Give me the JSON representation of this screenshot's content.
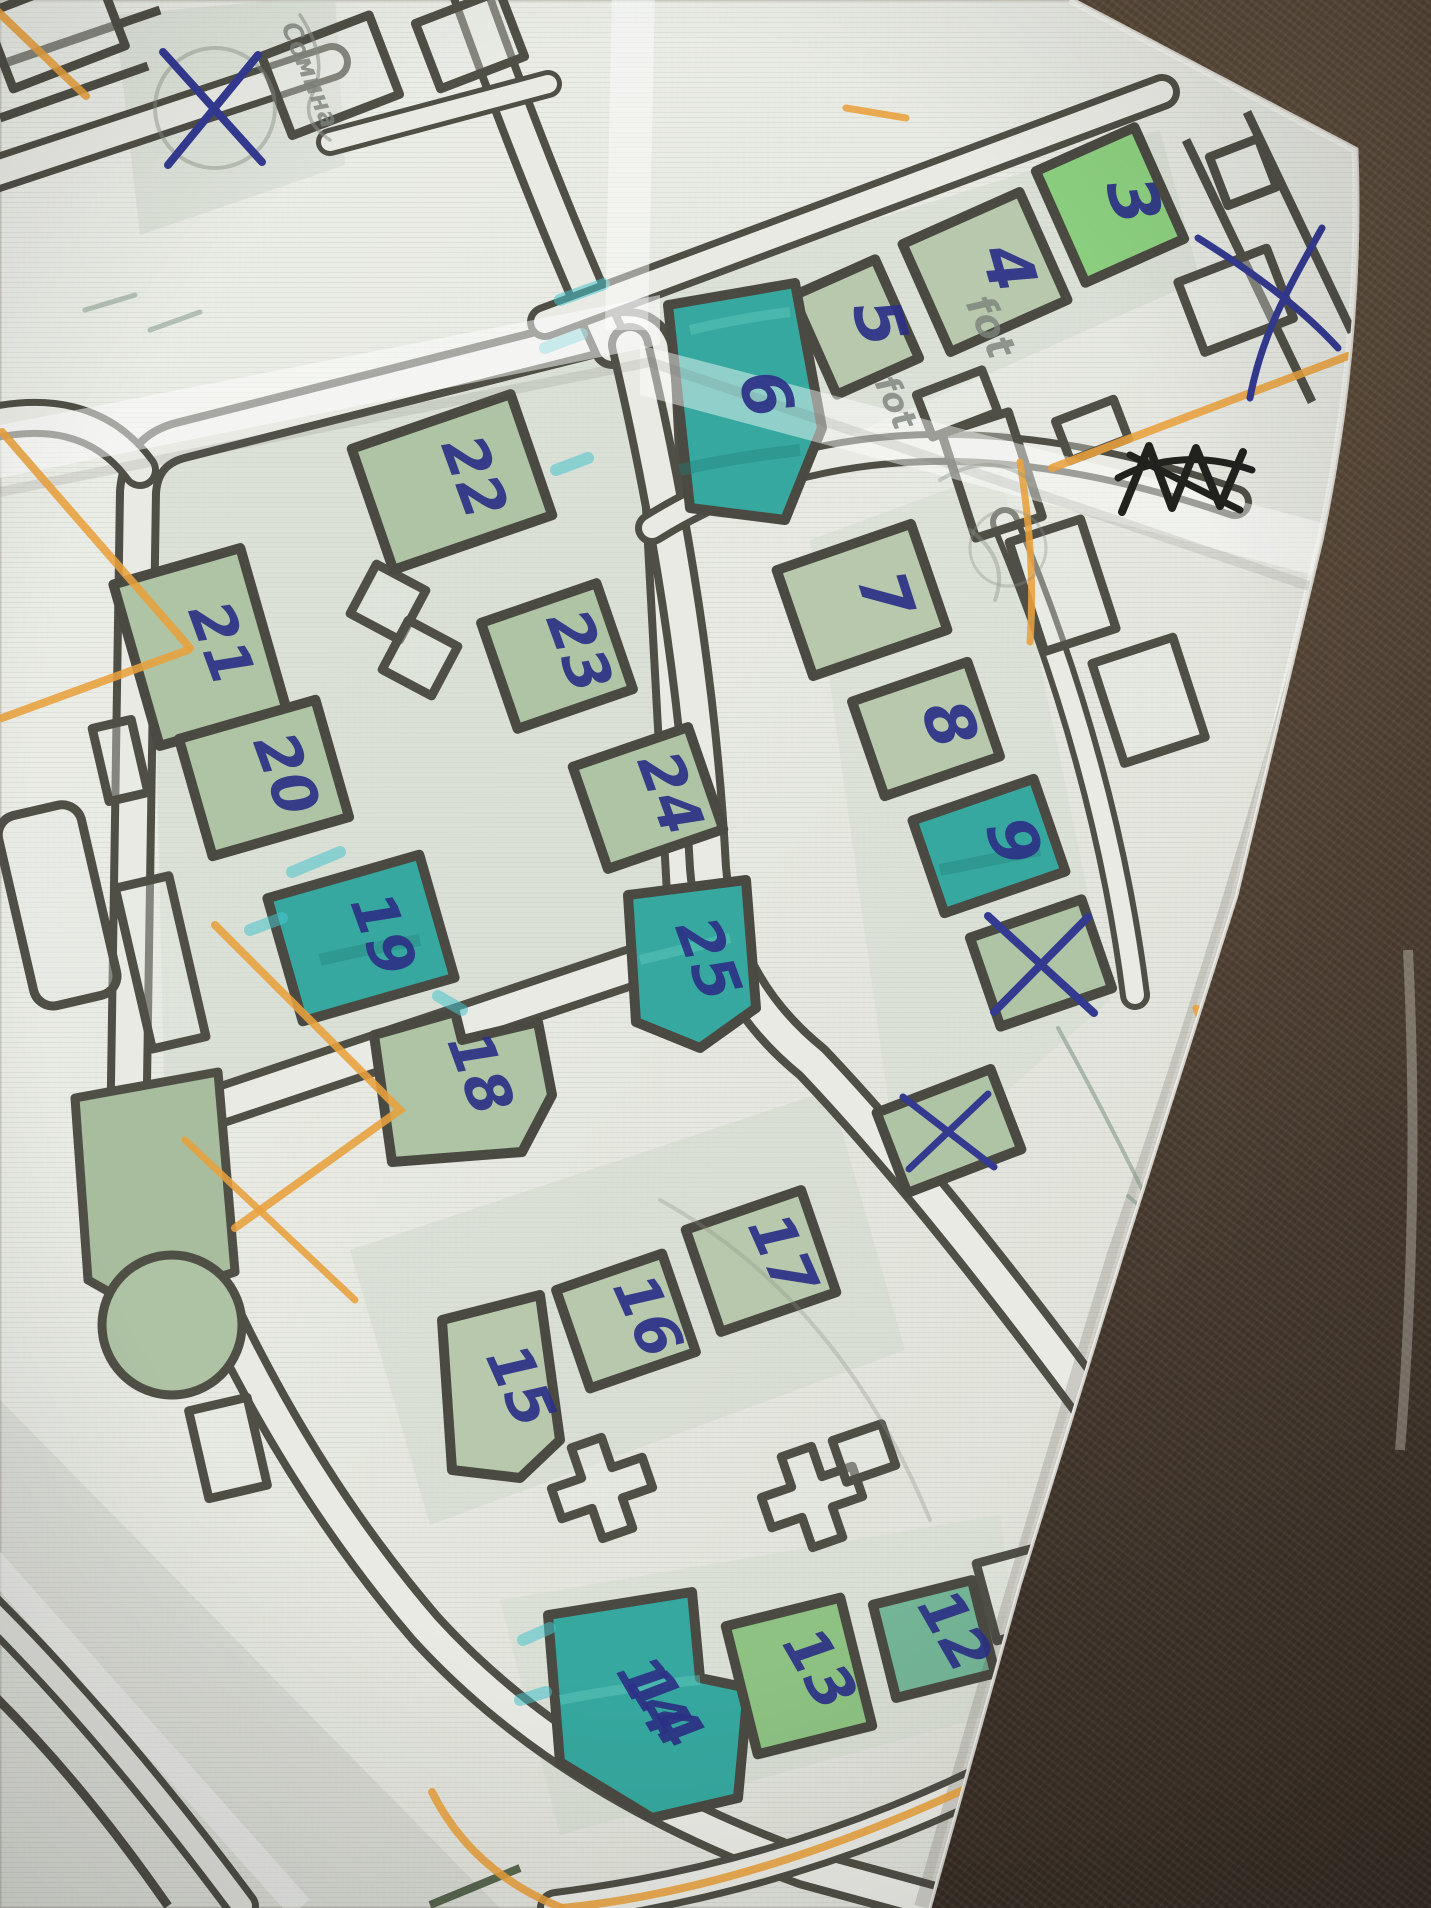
{
  "scene": {
    "description": "Photograph of a printed street/parcel map lying on a dark brown leather surface, hand-annotated with blue ballpoint plot numbers, X cross-outs, teal highlighter, orange and graphite pencil marks",
    "surface": "dark brown leather",
    "paper": "folded light map sheet with visible creases"
  },
  "colors": {
    "paper": "#ebece7",
    "street_line": "#4f4f46",
    "plot_green": "#aec4a4",
    "plot_bright_green": "#8ccf7f",
    "plot_teal": "#36a89f",
    "ink_blue": "#2c3186",
    "pencil_gray": "#8a9086",
    "pencil_green": "#7c9480",
    "orange_pencil": "#e8a13c",
    "leather_brown": "#463a30"
  },
  "plots": [
    {
      "label": "3",
      "fill": "bright-green"
    },
    {
      "label": "4",
      "fill": "sage"
    },
    {
      "label": "5",
      "fill": "sage"
    },
    {
      "label": "6",
      "fill": "teal-highlight"
    },
    {
      "label": "7",
      "fill": "sage"
    },
    {
      "label": "8",
      "fill": "sage"
    },
    {
      "label": "9",
      "fill": "teal-highlight"
    },
    {
      "label": "12",
      "fill": "green-teal"
    },
    {
      "label": "13",
      "fill": "bright-green"
    },
    {
      "label": "14",
      "fill": "teal-highlight"
    },
    {
      "label": "15",
      "fill": "sage"
    },
    {
      "label": "16",
      "fill": "sage"
    },
    {
      "label": "17",
      "fill": "sage"
    },
    {
      "label": "18",
      "fill": "sage"
    },
    {
      "label": "19",
      "fill": "teal-highlight"
    },
    {
      "label": "20",
      "fill": "sage"
    },
    {
      "label": "21",
      "fill": "sage"
    },
    {
      "label": "22",
      "fill": "sage"
    },
    {
      "label": "23",
      "fill": "sage"
    },
    {
      "label": "24",
      "fill": "sage"
    },
    {
      "label": "25",
      "fill": "teal-highlight"
    }
  ],
  "crossed_plots": [
    {
      "mark": "X",
      "location": "top-left block"
    },
    {
      "mark": "X",
      "location": "below plot 9"
    },
    {
      "mark": "x",
      "location": "above plot 17"
    }
  ],
  "annotations": {
    "pencil_notes": [
      {
        "text": "Сомина"
      },
      {
        "text": "fot"
      },
      {
        "text": "fot"
      },
      {
        "text": "то 500"
      }
    ],
    "ink_scribbles": [
      {
        "type": "blue X scribble near top-right paper edge"
      },
      {
        "type": "black scratched-out scribble"
      }
    ],
    "highlighter": "teal marker over plots 6, 9, 14, 19, 25"
  }
}
